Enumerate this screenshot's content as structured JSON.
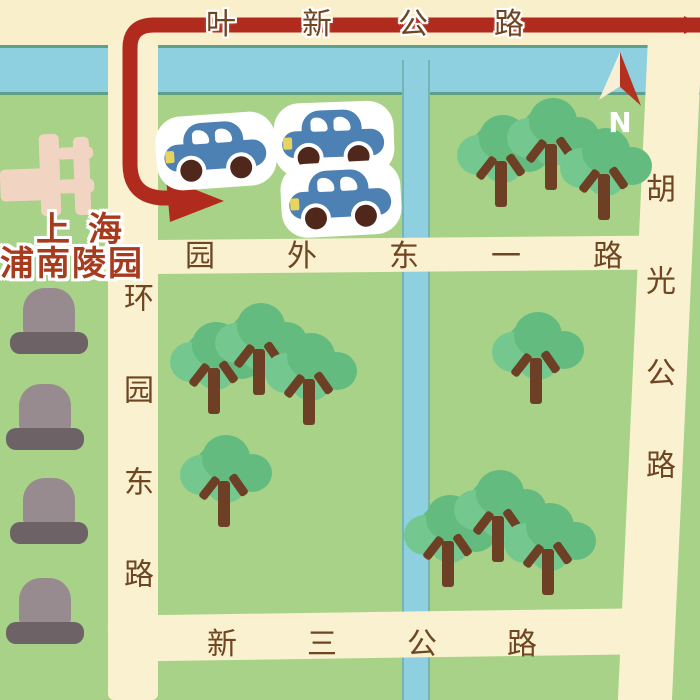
{
  "compass": {
    "label": "N"
  },
  "roads": {
    "yexin_label": "叶新公路",
    "yuanwai_label": "园外东一路",
    "xinsan_label": "新三公路",
    "huanyuan_label": "环园东路",
    "huguang_label": "胡光公路"
  },
  "cemetery": {
    "name_line1": "上海",
    "name_line2": "浦南陵园"
  },
  "icons": {
    "route": "red-route-arrow",
    "compass": "north-arrow",
    "tree": "tree-icon",
    "tombstone": "tombstone-icon",
    "car": "car-icon",
    "gate": "cemetery-gate-icon"
  },
  "colors": {
    "bg": "#f9efca",
    "river": "#8ecfe0",
    "river-edge": "#5fa08b",
    "grass": "#a7d288",
    "road": "#f9f1cf",
    "route": "#b02b1d",
    "label": "#6f4522",
    "title": "#a63b1d",
    "canopy": "#63bb80",
    "canopy2": "#74c78f",
    "trunk": "#6d4026",
    "tomb": "#978b8f",
    "tombbase": "#6d6266",
    "pink": "#f2d4c2",
    "carblue": "#4d80b3",
    "wheel": "#50281b",
    "light": "#e6d45f"
  }
}
